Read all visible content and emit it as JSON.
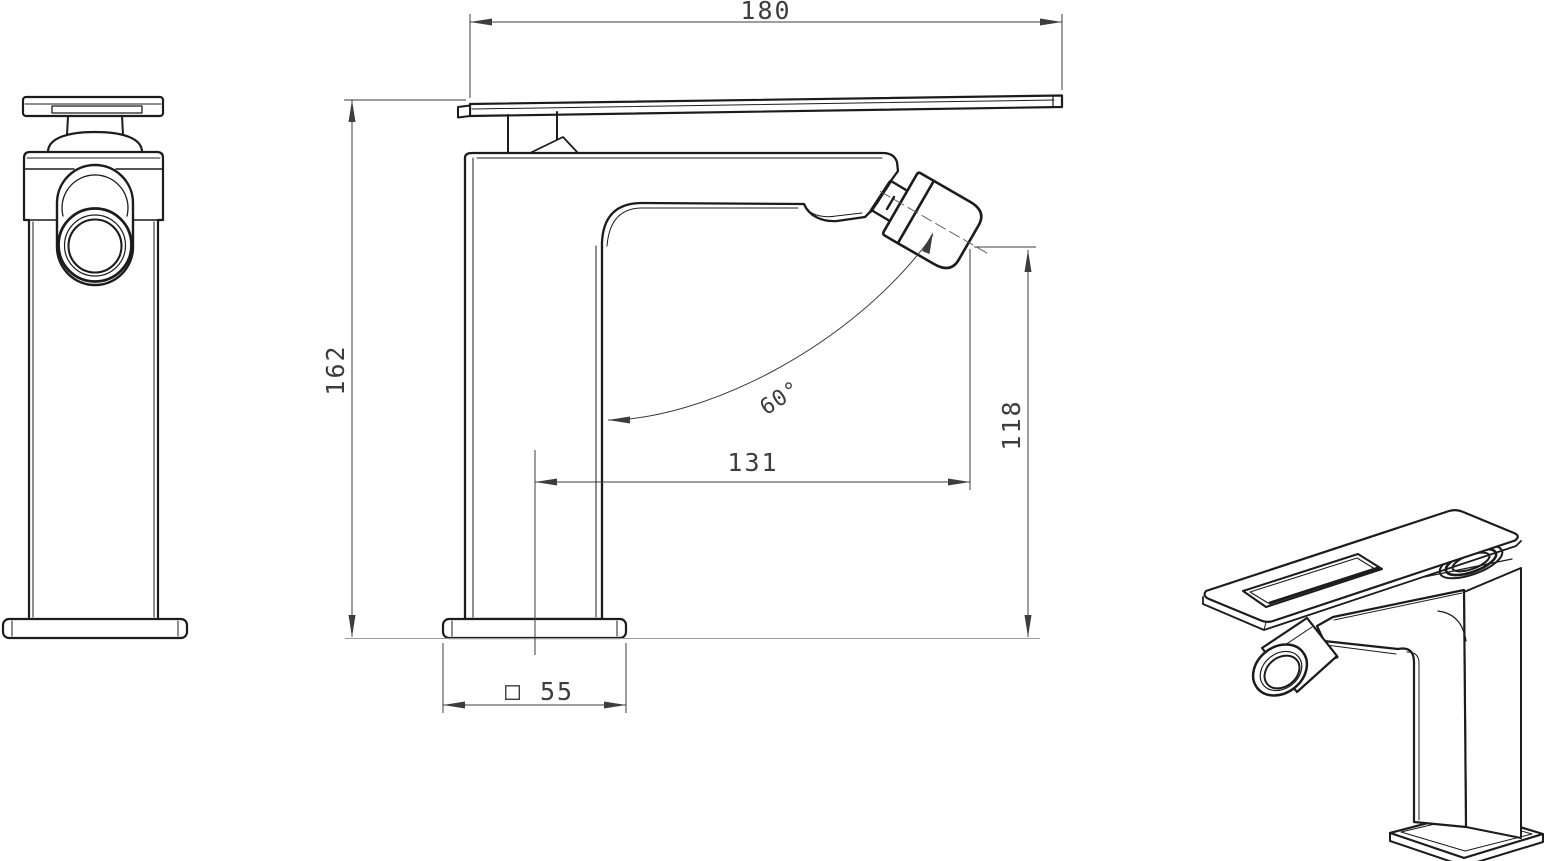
{
  "drawing": {
    "type": "technical-dimension-drawing",
    "subject": "single-lever bidet/basin mixer faucet, three views",
    "dimensions": {
      "handle_length": "180",
      "total_height": "162",
      "spout_reach": "131",
      "spray_height": "118",
      "spray_angle": "60°",
      "base_symbol": "□",
      "base_size": "55"
    },
    "colors": {
      "line": "#1c1c1c",
      "detail": "#2a2a2a",
      "dim": "#3d3d3d",
      "surface": "#9b9b9b",
      "background": "#ffffff"
    }
  }
}
